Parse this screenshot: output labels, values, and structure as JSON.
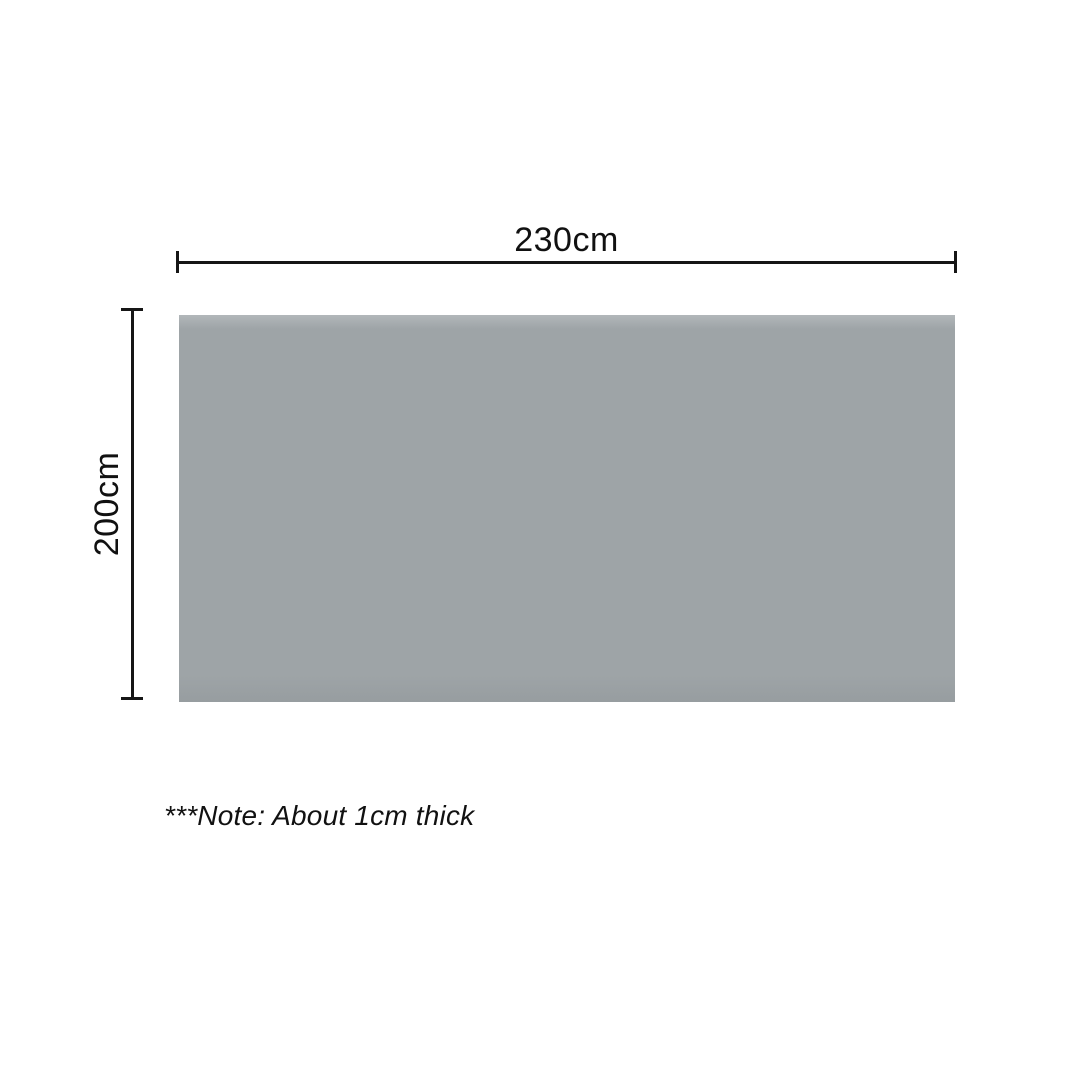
{
  "diagram": {
    "title": "product-dimensions-diagram",
    "product": {
      "shape": "rectangle",
      "fill_color": "#9ea4a7"
    },
    "dimensions": {
      "width": {
        "label": "230cm",
        "value": 230,
        "unit": "cm",
        "orientation": "horizontal"
      },
      "height": {
        "label": "200cm",
        "value": 200,
        "unit": "cm",
        "orientation": "vertical"
      },
      "thickness": {
        "value": 1,
        "unit": "cm"
      }
    },
    "note": "***Note: About 1cm thick",
    "colors": {
      "background": "#ffffff",
      "dimension_line": "#161616",
      "text": "#111111"
    }
  }
}
